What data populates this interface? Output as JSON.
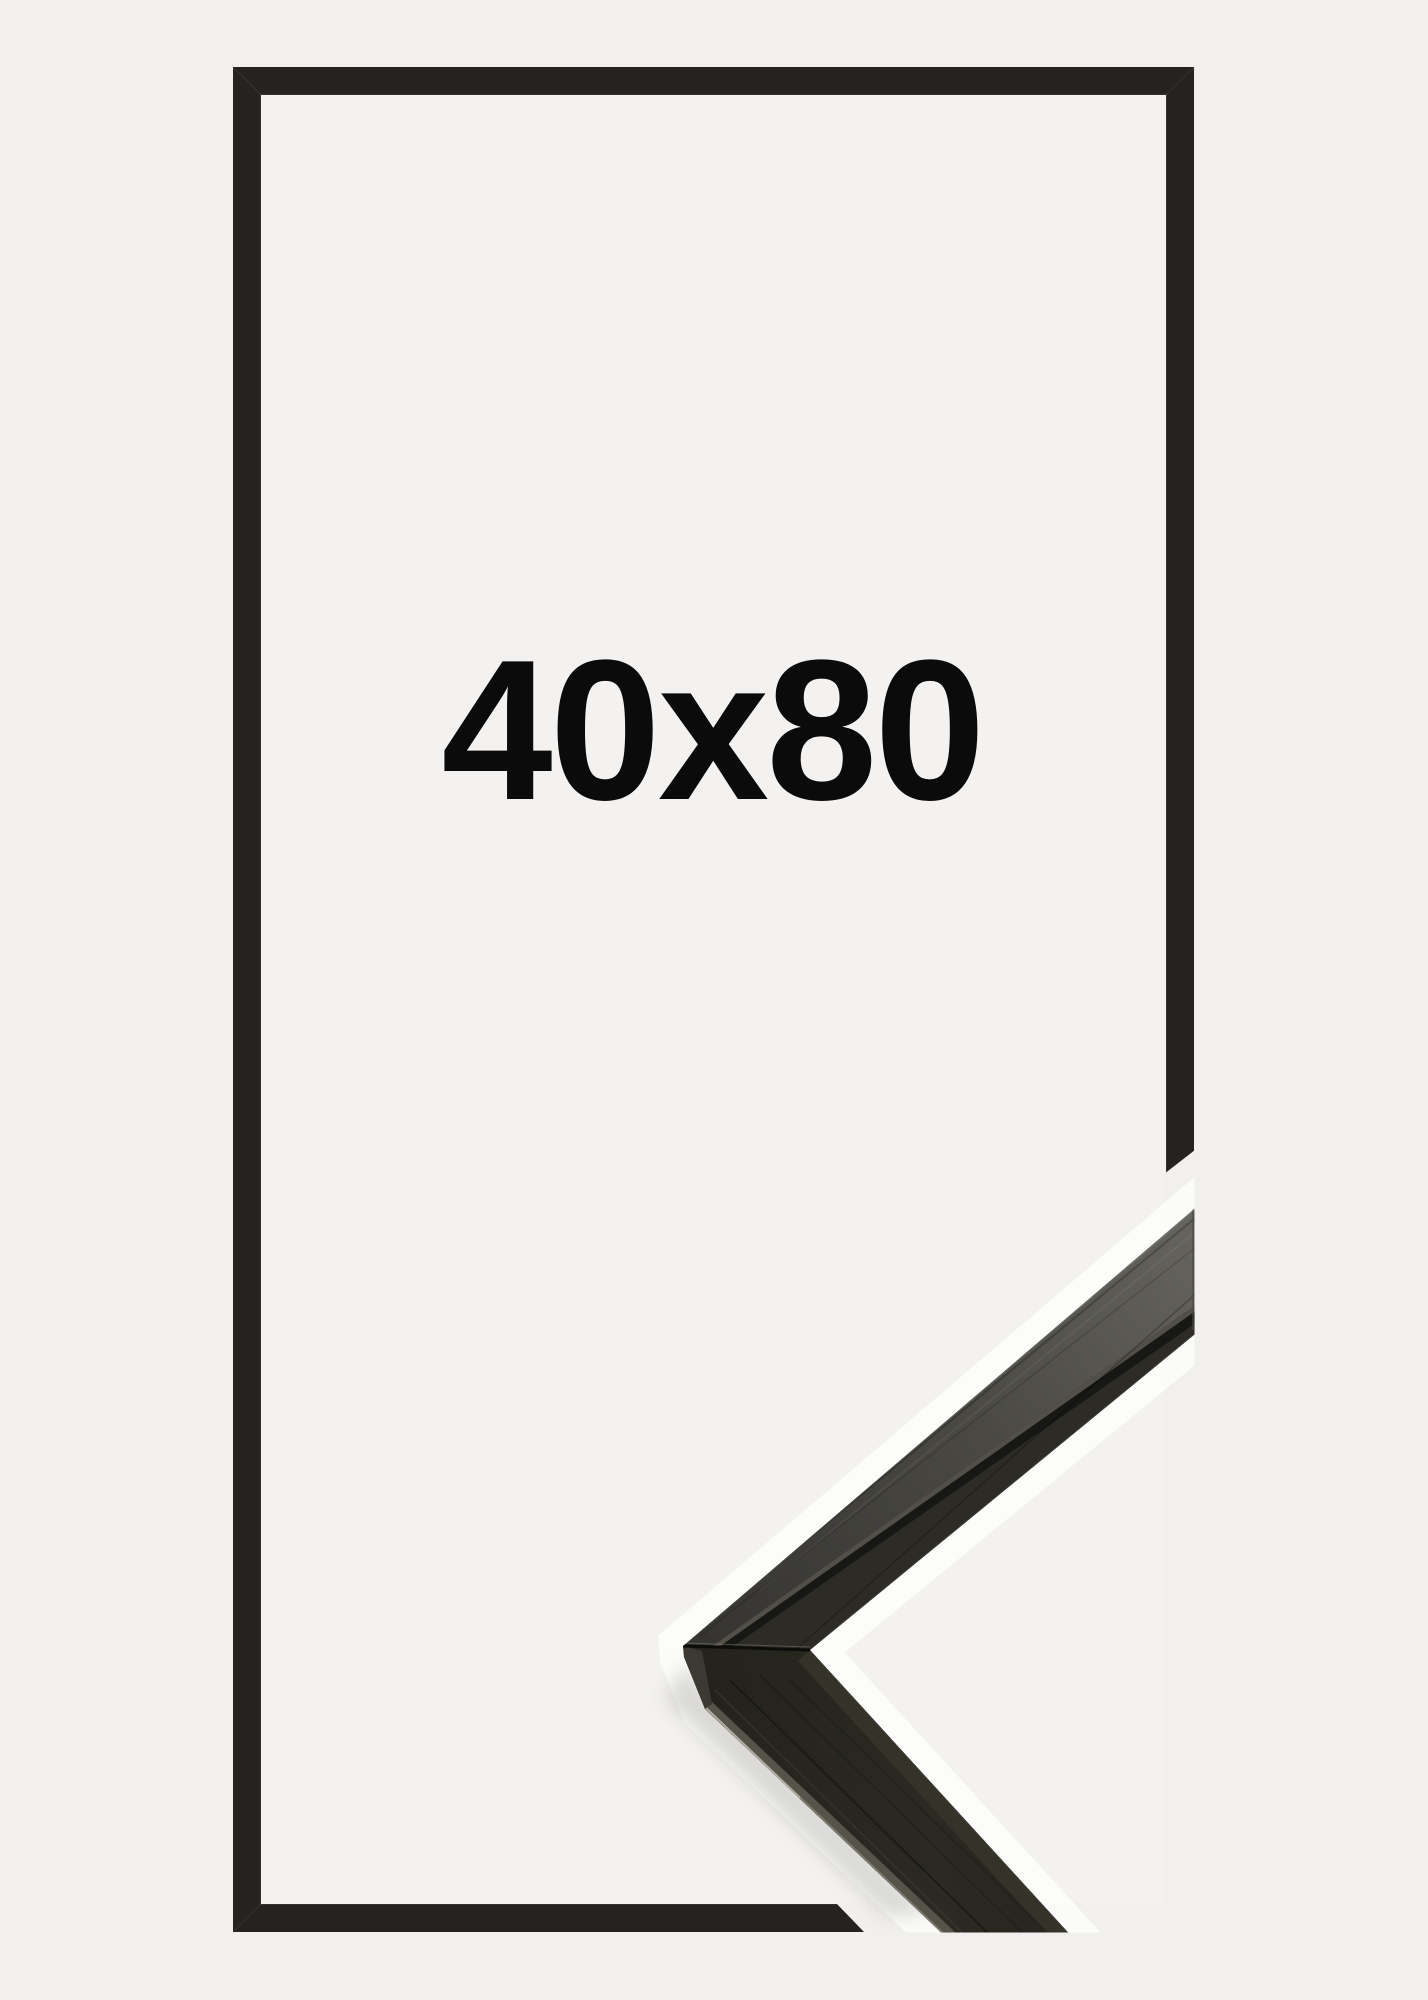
{
  "product": {
    "size_label": "40x80"
  },
  "colors": {
    "background": "#f1f0ee",
    "inner_panel": "#f3f2f0",
    "frame_outline": "#242320",
    "label_text": "#0b0b0b",
    "moulding_face": "#27261f",
    "moulding_top_light": "#66655f",
    "halo": "#ffffff"
  }
}
